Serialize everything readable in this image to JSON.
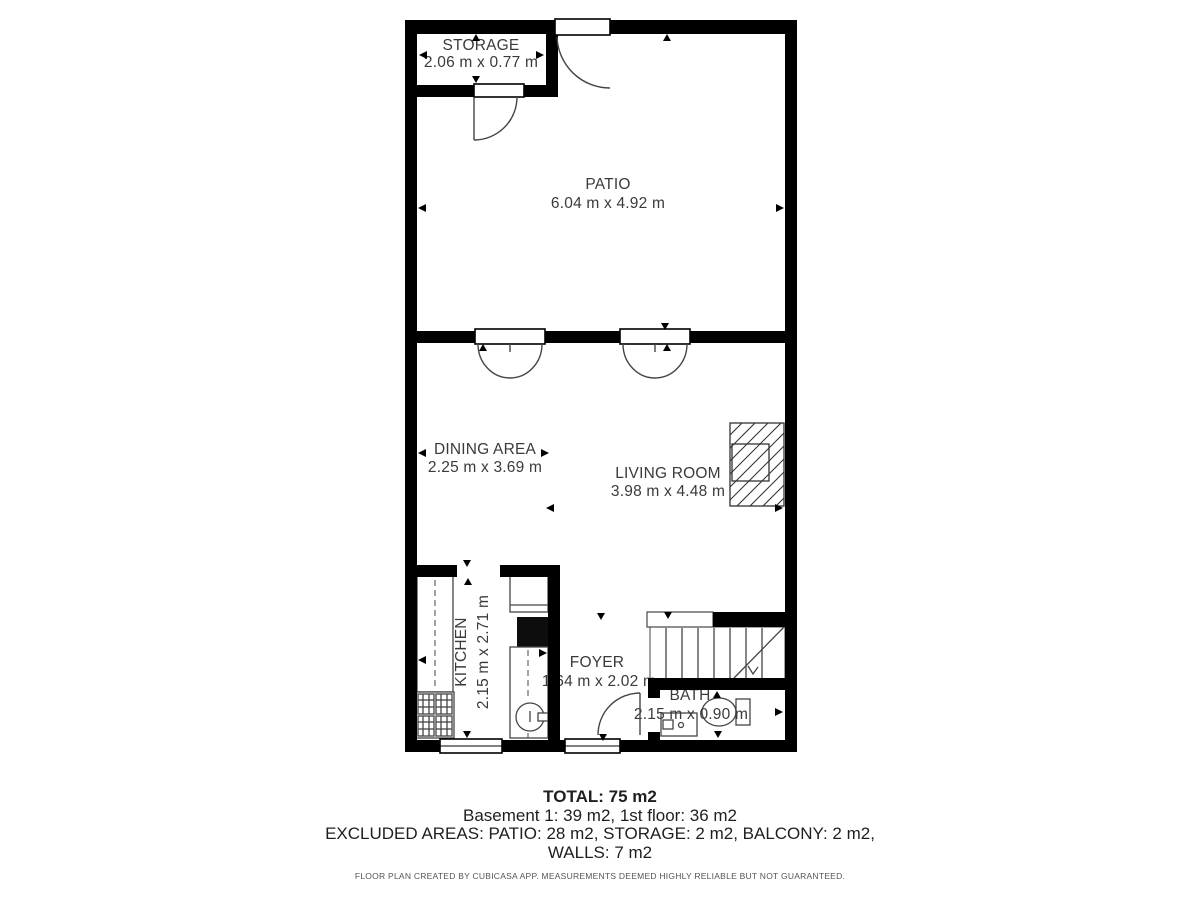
{
  "floorplan": {
    "rooms": [
      {
        "name": "STORAGE",
        "dims": "2.06 m x 0.77 m"
      },
      {
        "name": "PATIO",
        "dims": "6.04 m x 4.92 m"
      },
      {
        "name": "DINING AREA",
        "dims": "2.25 m x 3.69 m"
      },
      {
        "name": "LIVING ROOM",
        "dims": "3.98 m x 4.48 m"
      },
      {
        "name": "KITCHEN",
        "dims": "2.15 m x 2.71 m"
      },
      {
        "name": "FOYER",
        "dims": "1.64 m x 2.02 m"
      },
      {
        "name": "BATH",
        "dims": "2.15 m x 0.90 m"
      }
    ],
    "summary": {
      "total": "TOTAL: 75 m2",
      "floors": "Basement 1: 39 m2, 1st floor: 36 m2",
      "excluded_line1": "EXCLUDED AREAS: PATIO: 28 m2, STORAGE: 2 m2, BALCONY: 2 m2,",
      "excluded_line2": "WALLS: 7 m2"
    },
    "disclaimer": "FLOOR PLAN CREATED BY CUBICASA APP. MEASUREMENTS DEEMED HIGHLY RELIABLE BUT NOT GUARANTEED.",
    "colors": {
      "wall": "#000000",
      "line": "#454545",
      "text": "#3a3a3a"
    }
  }
}
